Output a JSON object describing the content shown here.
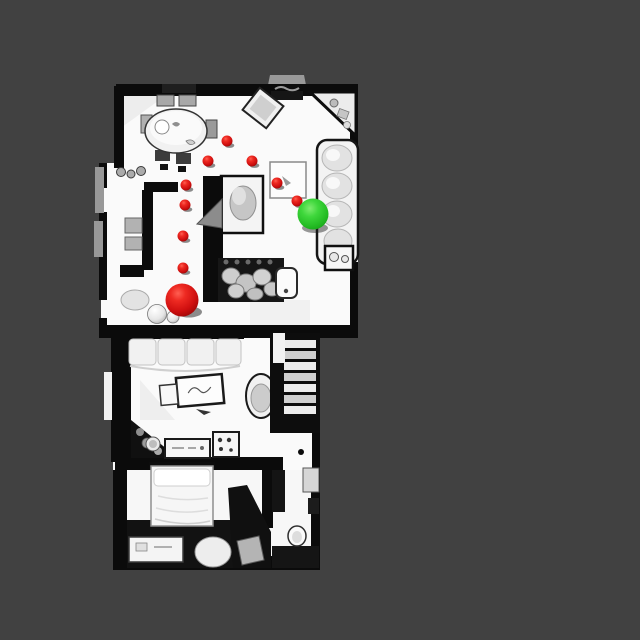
{
  "scene": {
    "type": "top-down 3D scan floor plan render",
    "background_color": "#414141",
    "floor_color": "#fafafa",
    "wall_color": "#0b0b0b",
    "furniture_gray": "#b5b5b5",
    "canvas": {
      "width": 640,
      "height": 640
    },
    "map_bounds": {
      "x": 95,
      "y": 75,
      "width": 265,
      "height": 500
    }
  },
  "navigation": {
    "waypoint_color": "#d11212",
    "waypoint_radius": 5.5,
    "waypoints": [
      {
        "x": 183,
        "y": 268
      },
      {
        "x": 183,
        "y": 236
      },
      {
        "x": 185,
        "y": 205
      },
      {
        "x": 186,
        "y": 185
      },
      {
        "x": 208,
        "y": 161
      },
      {
        "x": 227,
        "y": 141
      },
      {
        "x": 252,
        "y": 161
      },
      {
        "x": 277,
        "y": 183
      },
      {
        "x": 297,
        "y": 201
      }
    ],
    "agent": {
      "x": 182,
      "y": 300,
      "radius": 16.5,
      "color": "#d11212"
    },
    "goal": {
      "x": 313,
      "y": 214,
      "radius": 15.5,
      "color": "#23bb23"
    }
  }
}
